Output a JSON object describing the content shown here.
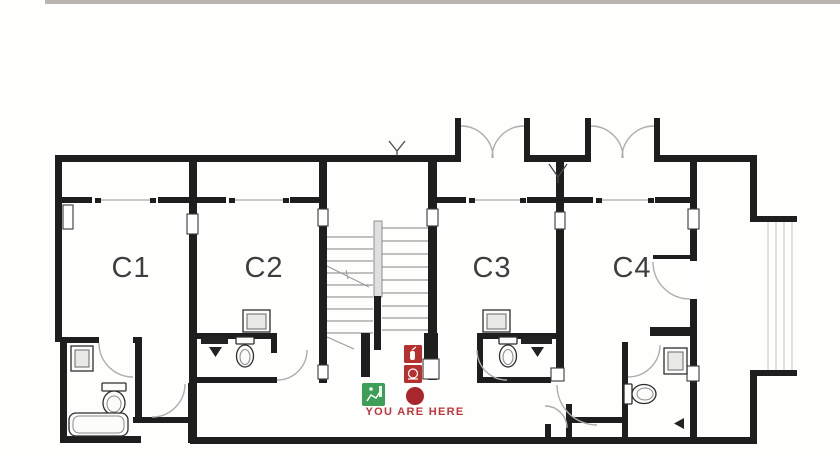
{
  "top_bar": {
    "color": "#b9b5b0"
  },
  "floor_plan": {
    "wall_color": "#1e1e1e",
    "door_arc_color": "#aeaeae",
    "glazing_color": "#c9c9c9",
    "tread_color": "#9b9b9b",
    "railing_color": "#c4c4c4",
    "label_color": "#3e3e3e",
    "rooms": [
      {
        "label": "C1"
      },
      {
        "label": "C2"
      },
      {
        "label": "C3"
      },
      {
        "label": "C4"
      }
    ],
    "marker": {
      "label": "YOU ARE HERE",
      "dot_color": "#a8262c",
      "text_color": "#c23439"
    },
    "safety_icons": {
      "exit_green": "#3d9e57",
      "fire_red": "#b5302e"
    }
  }
}
